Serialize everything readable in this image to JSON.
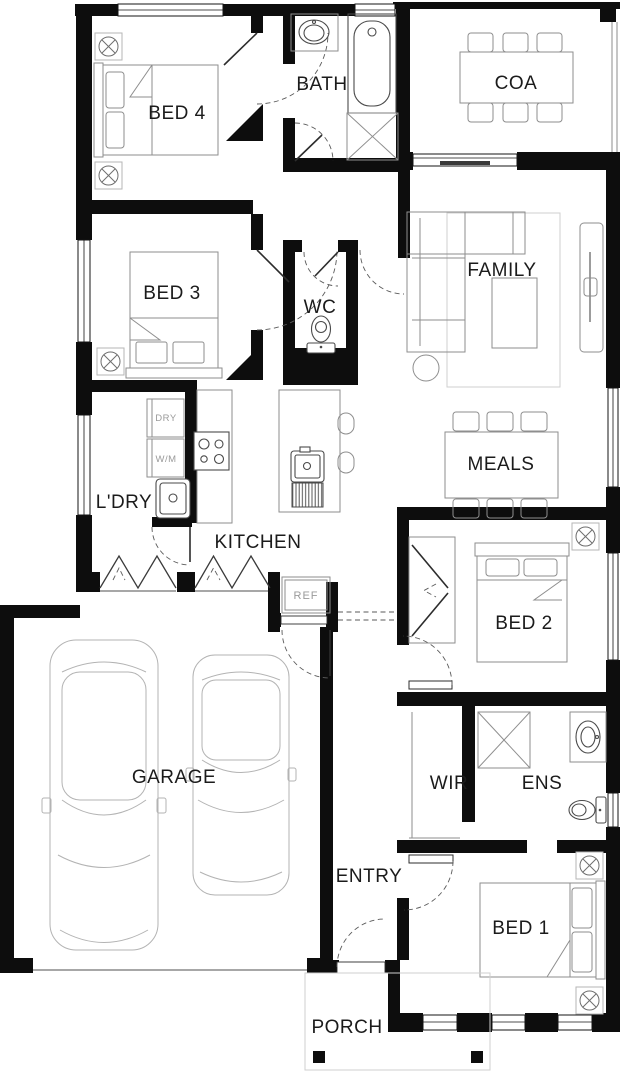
{
  "plan": {
    "title": "Single storey home floor plan",
    "rooms": {
      "bed4": "BED 4",
      "bath": "BATH",
      "coa": "COA",
      "family": "FAMILY",
      "bed3": "BED 3",
      "wc": "WC",
      "laundry": "L'DRY",
      "kitchen": "KITCHEN",
      "meals": "MEALS",
      "bed2": "BED 2",
      "garage": "GARAGE",
      "wir": "WIR",
      "ens": "ENS",
      "entry": "ENTRY",
      "bed1": "BED 1",
      "porch": "PORCH"
    },
    "appliances": {
      "dryer": "DRY",
      "washer": "W/M",
      "fridge": "REF"
    },
    "colors": {
      "wall": "#0d0d0d",
      "furniture_line": "#8e8e8e",
      "fixture_line": "#4a4a4a",
      "car_line": "#b3b3b3",
      "text": "#1b1b1b",
      "muted_text": "#9a9a9a",
      "background": "#ffffff"
    }
  }
}
